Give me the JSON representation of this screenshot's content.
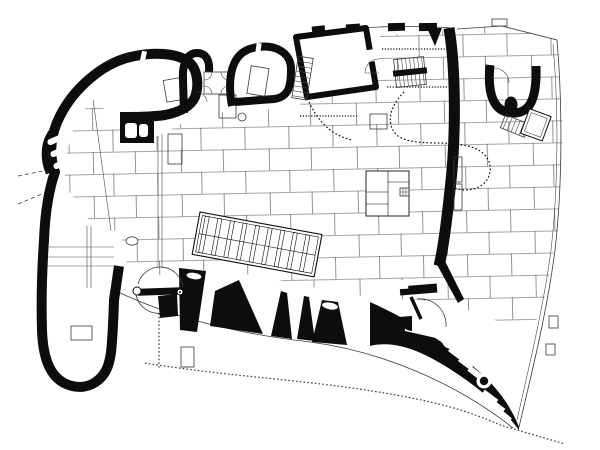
{
  "meta": {
    "drawing": "curved-wall chapel floor plan, black ink on white",
    "type": "architectural-plan"
  },
  "palette": {
    "background": "#ffffff",
    "ink": "#0d0d0d",
    "thin-line": "#3a3a3a",
    "paving-line": "#4a4a4a"
  },
  "repeat": {
    "pew_bars": 9,
    "sacristy_stair_treads": 8,
    "inner_stair_treads": 7,
    "chapel_stair_treads": 6
  }
}
